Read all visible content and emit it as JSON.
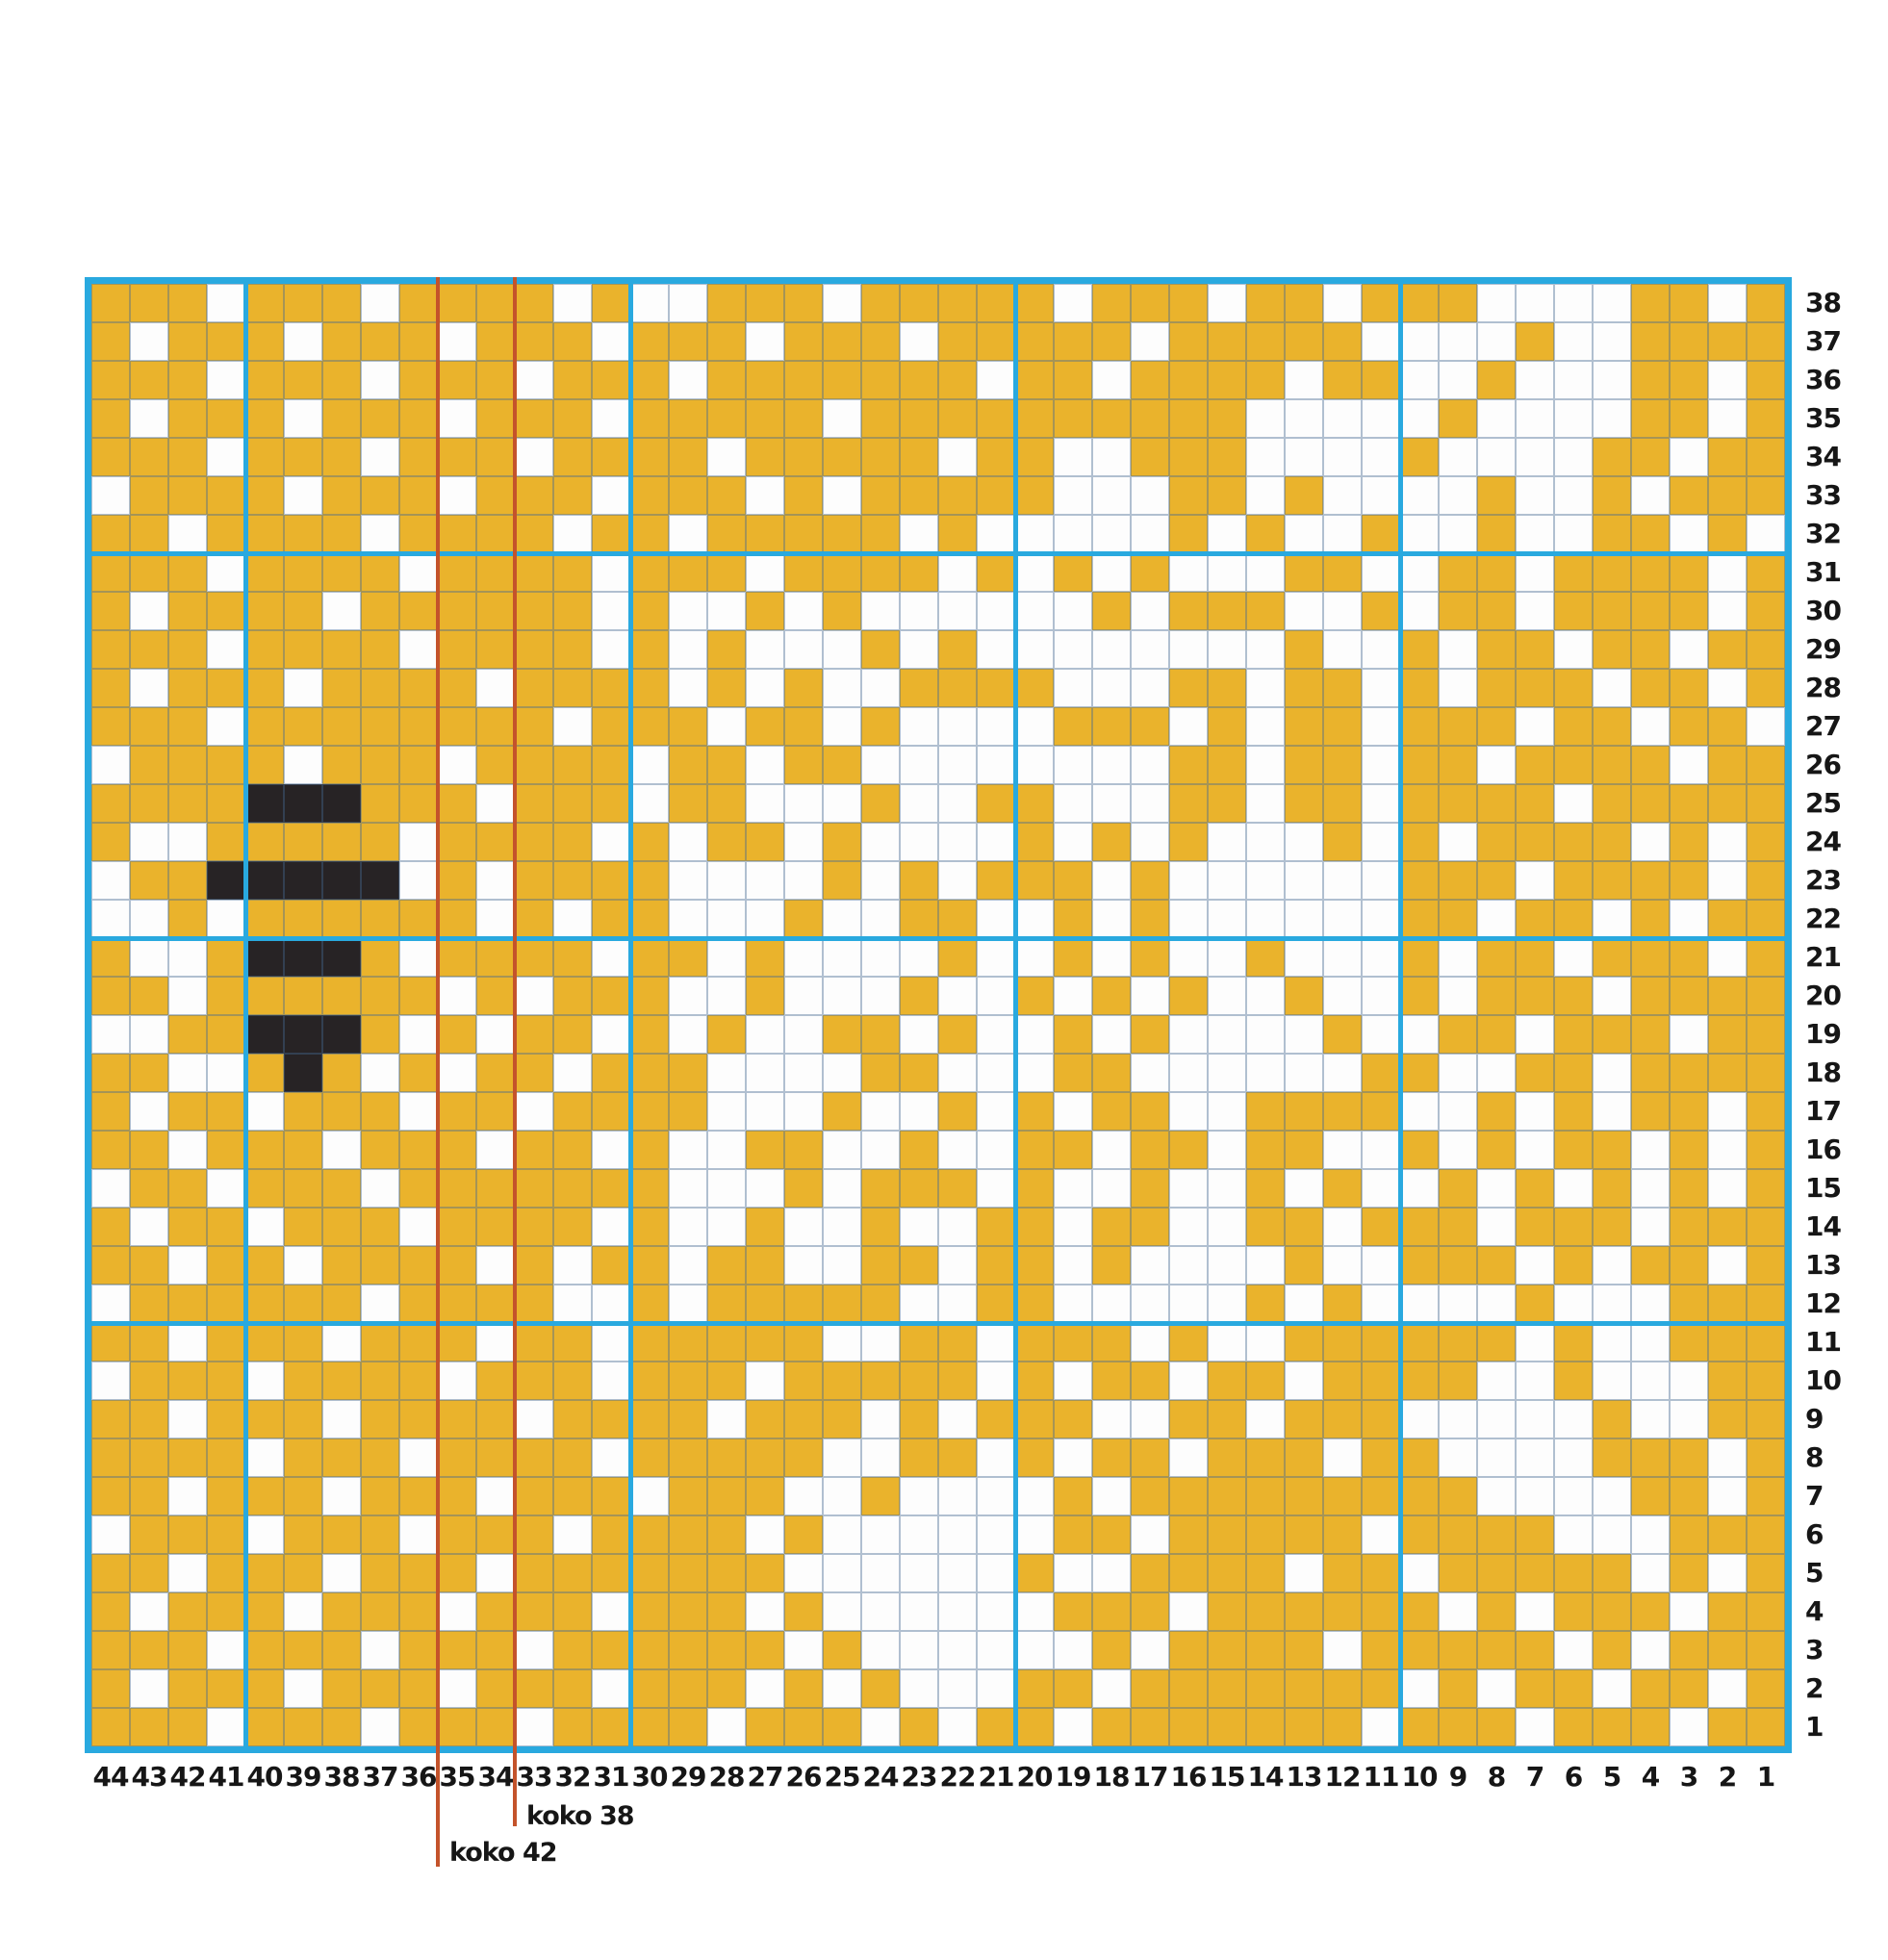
{
  "chart_data": {
    "type": "heatmap",
    "description": "Knitting colorwork chart, 44 stitches x 38 rows. Y = yellow stitch, W = white stitch, B = black stitch. Rows listed top to bottom (row 38 first); characters left to right (stitch 44 first).",
    "columns": 44,
    "rows": 38,
    "row_labels": [
      38,
      37,
      36,
      35,
      34,
      33,
      32,
      31,
      30,
      29,
      28,
      27,
      26,
      25,
      24,
      23,
      22,
      21,
      20,
      19,
      18,
      17,
      16,
      15,
      14,
      13,
      12,
      11,
      10,
      9,
      8,
      7,
      6,
      5,
      4,
      3,
      2,
      1
    ],
    "col_labels": [
      44,
      43,
      42,
      41,
      40,
      39,
      38,
      37,
      36,
      35,
      34,
      33,
      32,
      31,
      30,
      29,
      28,
      27,
      26,
      25,
      24,
      23,
      22,
      21,
      20,
      19,
      18,
      17,
      16,
      15,
      14,
      13,
      12,
      11,
      10,
      9,
      8,
      7,
      6,
      5,
      4,
      3,
      2,
      1
    ],
    "legend": {
      "Y": "yellow",
      "W": "white",
      "B": "black"
    },
    "colors": {
      "yellow": "#EAB32C",
      "white": "#FDFDFD",
      "black": "#272325",
      "grid_blue": "#29A9DF",
      "size_line_red": "#C4532B"
    },
    "section_breaks": {
      "vertical_after_columns": [
        41,
        31,
        21,
        11
      ],
      "horizontal_after_rows": [
        31,
        21,
        11
      ]
    },
    "size_lines": [
      {
        "label": "koko 38",
        "after_column": 34
      },
      {
        "label": "koko 42",
        "after_column": 36
      }
    ],
    "pattern": [
      "YYYWYYYWYYYYWYWWYYYWYYYYYWYYYWYYWYYYWWWWYYWY",
      "YWYYYWYYYWYYYWYYYWYYYWYYYYYWYYYYYWWWWYWWYYYY",
      "YYYWYYYWYYYWYYYWYYYYYYYWYYWYYYYWYYWWYWWWYYWY",
      "YWYYYWYYYWYYYWYYYYYWYYYYYYYYYYWWWWWYWWWWYYWY",
      "YYYWYYYWYYYWYYYYWYYYYYWYYWWYYYWWWWYWWWWYYWYY",
      "WYYYYWYYYWYYYWYYYWYWYYYYYWWWYYWYWWWWYWWYWYYY",
      "YYWYYYYWYYYYWYYWYYYYYWYWWWWWYWYWWYWWYWWYYWYW",
      "YYYWYYYYWYYYYWYYYWYYYYWYWYWYWWWYYWWYYWYYYYWY",
      "YWYYYYWYYYYYYWYWWYWYWWWWWWYWYYYWWYWYYWYYYYWY",
      "YYYWYYYYWYYYYWYWYWWWYWYWWWWWWWWYWWYWYYWYYWYY",
      "YWYYYWYYYYWYYYYWYWYWWYYYYWWWYYWYYWYWYYYWYYWY",
      "YYYWYYYYYYYYWYYYWYYWYWWWWYYYWYWYYWYYYWYYWYYW",
      "WYYYYWYYYWYYYYWYYWYYWWWWWWWWYYWYYWYYWYYYYWYY",
      "YYYYBBBYYYWYYYWYYWWWYWWYYWWWYYWYYWYYYYWYYYYY",
      "YWWYYYYYWYYYYWYWYYWYWWWWYWYWYWWWYWYWYYYYWYWY",
      "WYYBBBBBWYWYYYYWWWWYWYWYYYWYWWWWWWYYYWYYYYWY",
      "WWYWYYYYYYWYWYYWWWYWWYYWWYWYWWWWWWYYWYYWYWYY",
      "YWWYBBBYWYYYYWYYWYWWWWYWWYWYWWYWWWYWYYWYYYWY",
      "YYWYYYYYYWYWYYYWWYWWWYWWYWYWYWWYWWYWYYYWYYYY",
      "WWYYBBBYWYWYYWYWYWWYYWYWWYWYWWWWYWWYYWYYYWYY",
      "YYWWYBYWYWYYWYYYWWWWYYWWWYYWWWWWWYYWWYYWYYYY",
      "YWYYWYYYWYYWYYYYWWWYWWYWYWYYWWYYYYWWYWYWYYWY",
      "YYWYYYWYYYWYYWYWWYYWWYWWYYWYYWYYWWYWYWYYWYWY",
      "WYYWYYYWYYYYYYYWWWYWYYYWYWWYWWYWYWWYWYWYWYWY",
      "YWYYWYYYWYYYYWYWWYWWYWWYYWYYWWYYWYYYWYYYWYYY",
      "YYWYYWYYYYWYWYYWYYWWYYWYYWYWWWWYWWYYYWYWYYWY",
      "WYYYYYYWYYYYWWYWYYYYYWWYYWWWWWYWYWWWWYWWWYYY",
      "YYWYYYWYYYWYYWYYYYYWWYYWYYYWYWWYYYYYYWYWWYYY",
      "WYYYWYYYYWYYYWYYYWYYYYYWYWYYWYYWYYYYWWYWWWYY",
      "YYWYYYWYYYYWYYYYWYYYWYWYYYWWYYWYYYWWWWWYWWYY",
      "YYYYWYYYWYYYYWYYYYYWWYYWYWYYWYYYWYYWWWWYYYWY",
      "YYWYYYWYYYWYYYWYYYWWYWWWWYWYYYYYYYYYWWWWYYWY",
      "WYYYWYYYWYYYWYYYYWYWWWWWWYYWYYYYYWYYYYWWWYYY",
      "YYWYYYWYYYWYYYYYYYWWWWWWYWWYYYYWYYWYYYYYWYWY",
      "YWYYYWYYYWYYYWYYYWYWWWWWWYYYWYYYYYYWYWYYYWYY",
      "YYYWYYYWYYYWYYYYYYWYWWWWWWYWYYYYWYYYYYWYWYYY",
      "YWYYYWYYYWYYYWYYYWYWYWWWYYWYYYYYYYWYWYYWYYWY",
      "YYYWYYYWYYYWYYYYWYYYWYWYYWYYYYYYYWYYYWYYYWYY"
    ]
  }
}
